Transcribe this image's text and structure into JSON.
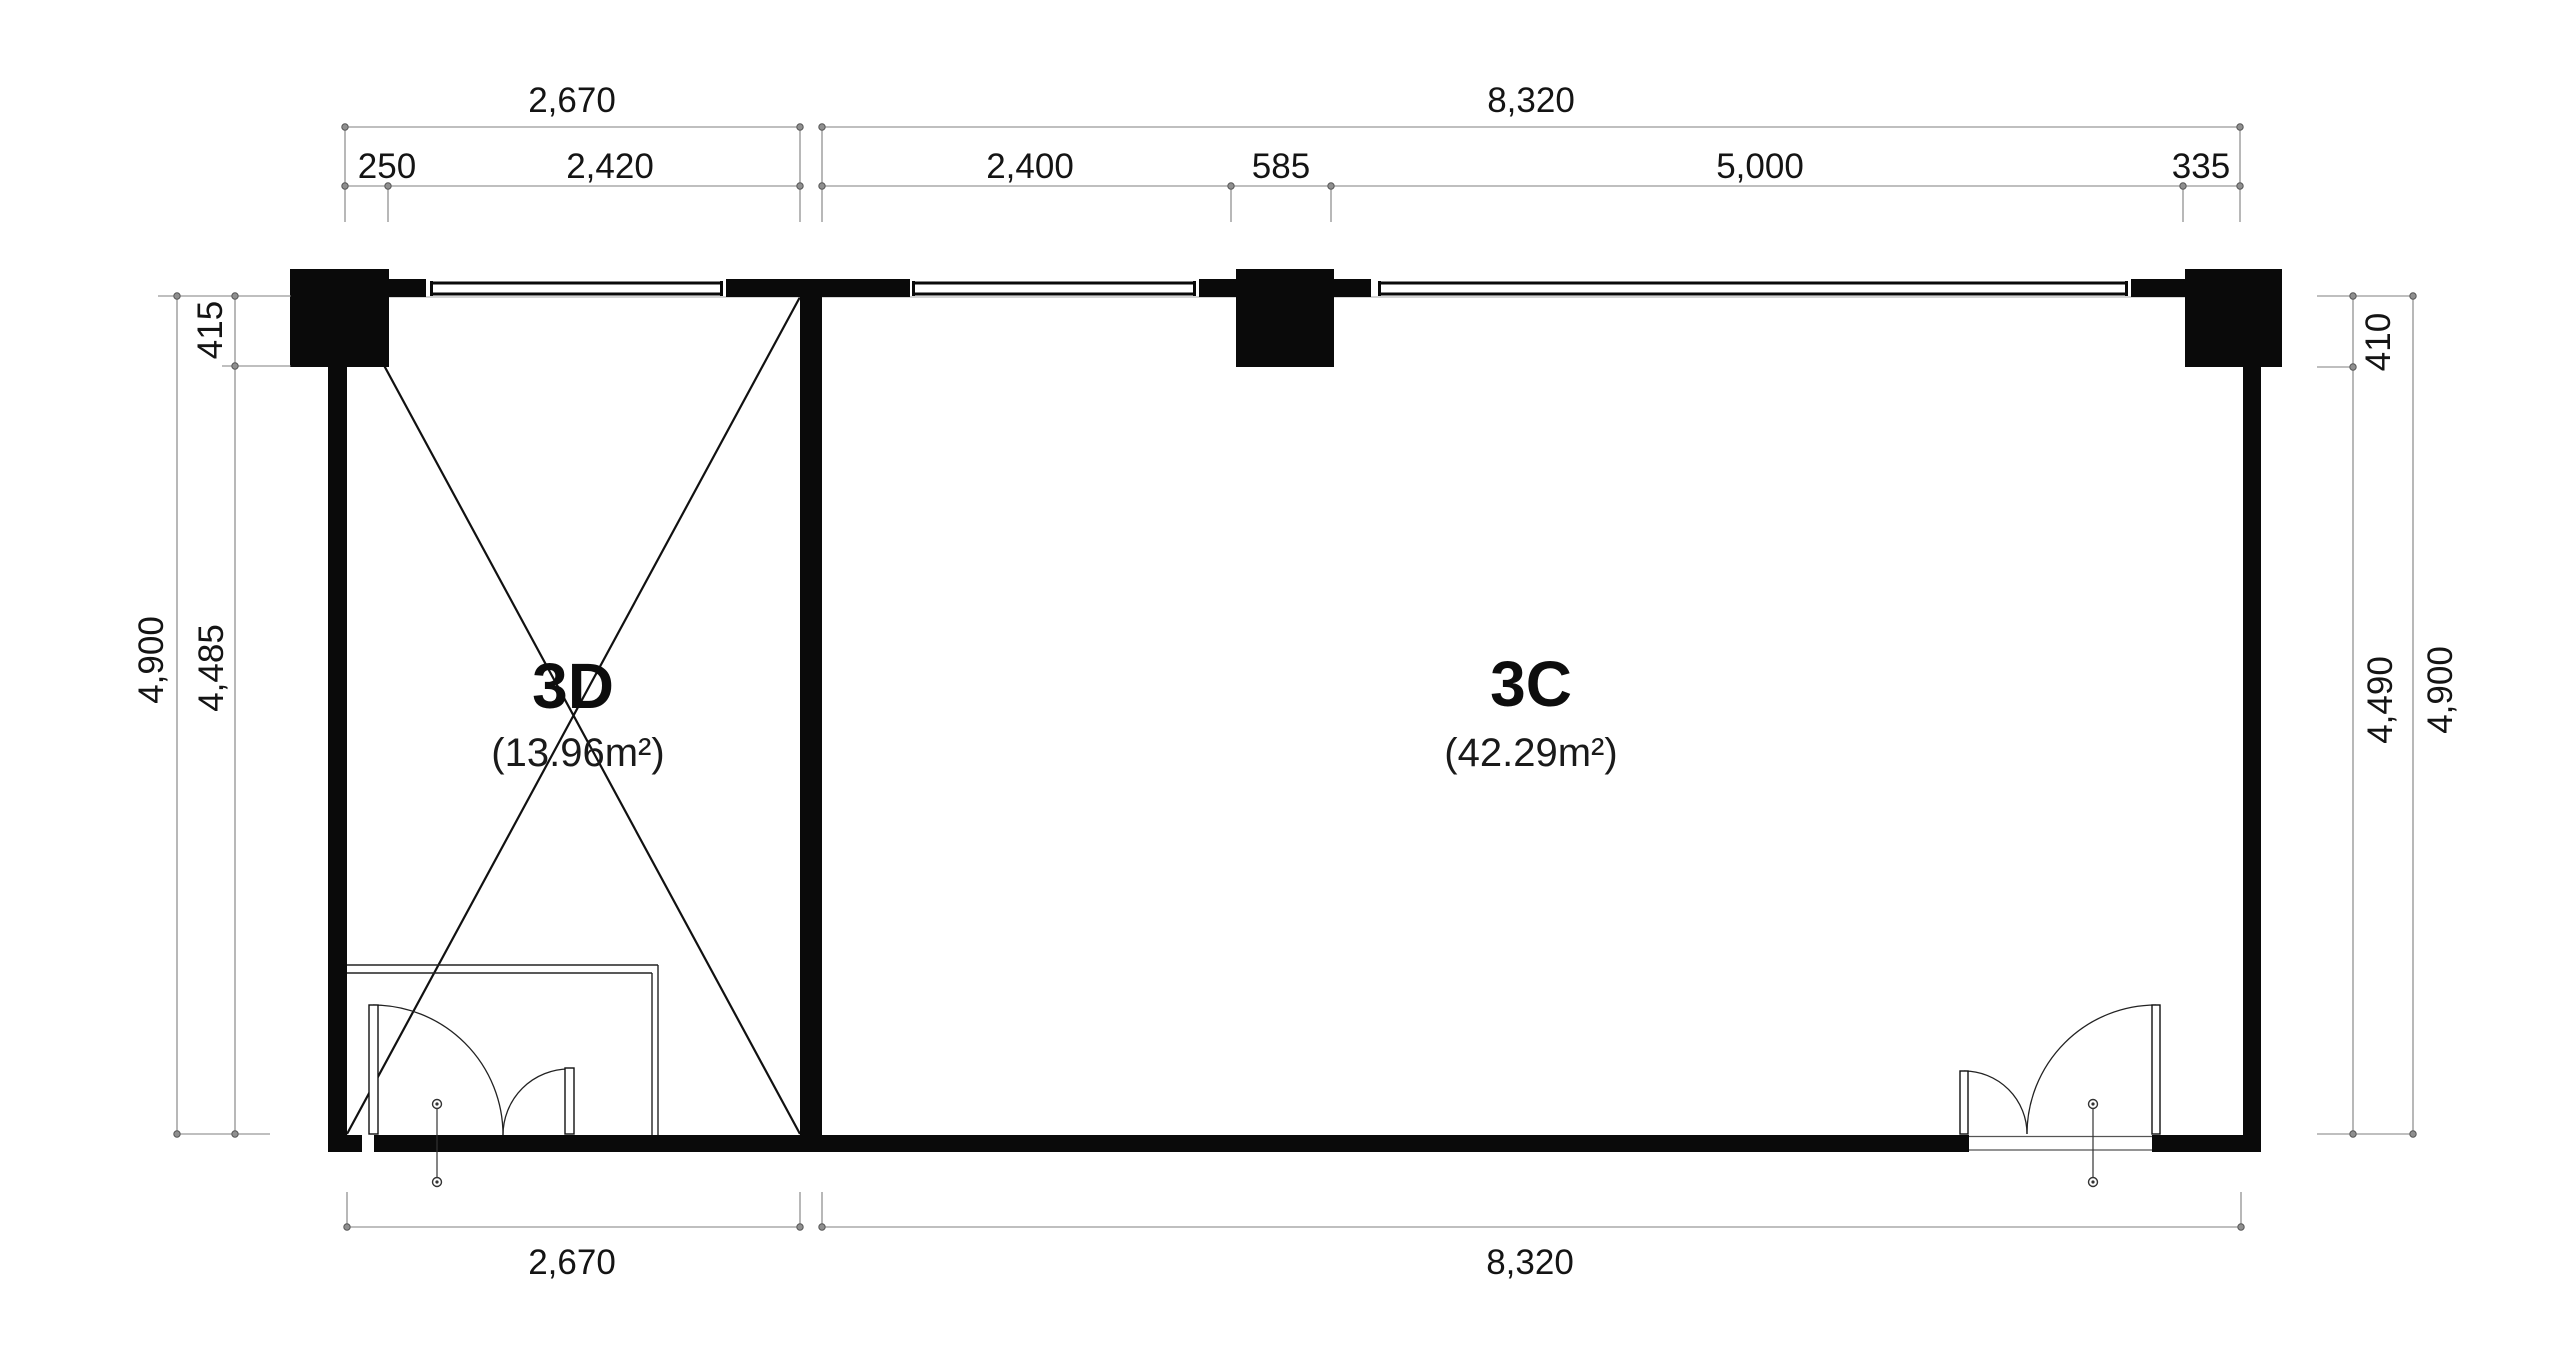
{
  "drawing": {
    "kind": "floor-plan",
    "rooms": {
      "d": {
        "name": "3D",
        "area": "(13.96m²)"
      },
      "c": {
        "name": "3C",
        "area": "(42.29m²)"
      }
    },
    "dimensions": {
      "top_overall": {
        "left": "2,670",
        "right": "8,320"
      },
      "top_segments": {
        "s250": "250",
        "s2420": "2,420",
        "s2400": "2,400",
        "s585": "585",
        "s5000": "5,000",
        "s335": "335"
      },
      "bottom": {
        "left": "2,670",
        "right": "8,320"
      },
      "left": {
        "top": "415",
        "inner": "4,485",
        "outer": "4,900"
      },
      "right": {
        "top": "410",
        "inner": "4,490",
        "outer": "4,900"
      }
    }
  },
  "colors": {
    "bg": "#ffffff",
    "wall": "#0a0a0a",
    "planline": "#222222",
    "dimline": "#7f7f7f",
    "dimtext": "#141414"
  }
}
